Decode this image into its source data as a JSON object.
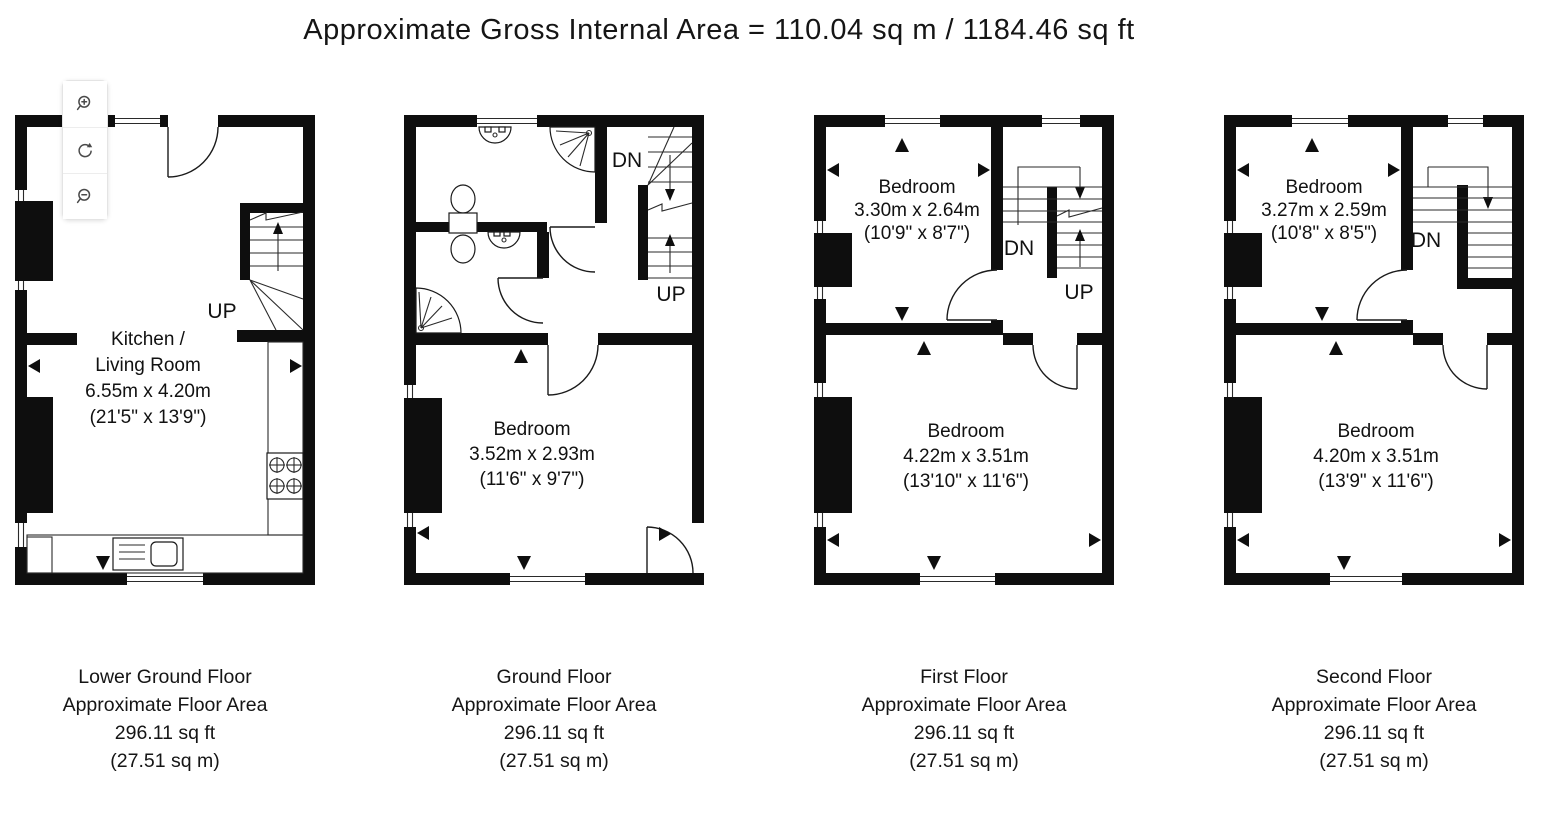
{
  "title": "Approximate Gross Internal Area = 110.04 sq m / 1184.46 sq ft",
  "toolbar": {
    "buttons": [
      {
        "name": "zoom-in",
        "icon": "magnifier-plus"
      },
      {
        "name": "rotate",
        "icon": "rotate-arrows"
      },
      {
        "name": "zoom-out",
        "icon": "magnifier-minus"
      }
    ]
  },
  "floors": [
    {
      "id": "lower-ground-floor",
      "rooms": [
        {
          "lines": [
            "Kitchen /",
            "Living Room",
            "6.55m x 4.20m",
            "(21'5\" x 13'9\")"
          ]
        }
      ],
      "stairs": {
        "up": "UP"
      },
      "caption": [
        "Lower Ground Floor",
        "Approximate Floor Area",
        "296.11 sq ft",
        "(27.51 sq m)"
      ]
    },
    {
      "id": "ground-floor",
      "rooms": [
        {
          "lines": [
            "Bedroom",
            "3.52m x 2.93m",
            "(11'6\" x 9'7\")"
          ]
        }
      ],
      "stairs": {
        "dn": "DN",
        "up": "UP"
      },
      "caption": [
        "Ground Floor",
        "Approximate Floor Area",
        "296.11 sq ft",
        "(27.51 sq m)"
      ]
    },
    {
      "id": "first-floor",
      "rooms": [
        {
          "lines": [
            "Bedroom",
            "3.30m x 2.64m",
            "(10'9\" x 8'7\")"
          ]
        },
        {
          "lines": [
            "Bedroom",
            "4.22m x 3.51m",
            "(13'10\" x 11'6\")"
          ]
        }
      ],
      "stairs": {
        "dn": "DN",
        "up": "UP"
      },
      "caption": [
        "First Floor",
        "Approximate Floor Area",
        "296.11 sq ft",
        "(27.51 sq m)"
      ]
    },
    {
      "id": "second-floor",
      "rooms": [
        {
          "lines": [
            "Bedroom",
            "3.27m x 2.59m",
            "(10'8\" x 8'5\")"
          ]
        },
        {
          "lines": [
            "Bedroom",
            "4.20m x 3.51m",
            "(13'9\" x 11'6\")"
          ]
        }
      ],
      "stairs": {
        "dn": "DN"
      },
      "caption": [
        "Second Floor",
        "Approximate Floor Area",
        "296.11 sq ft",
        "(27.51 sq m)"
      ]
    }
  ]
}
